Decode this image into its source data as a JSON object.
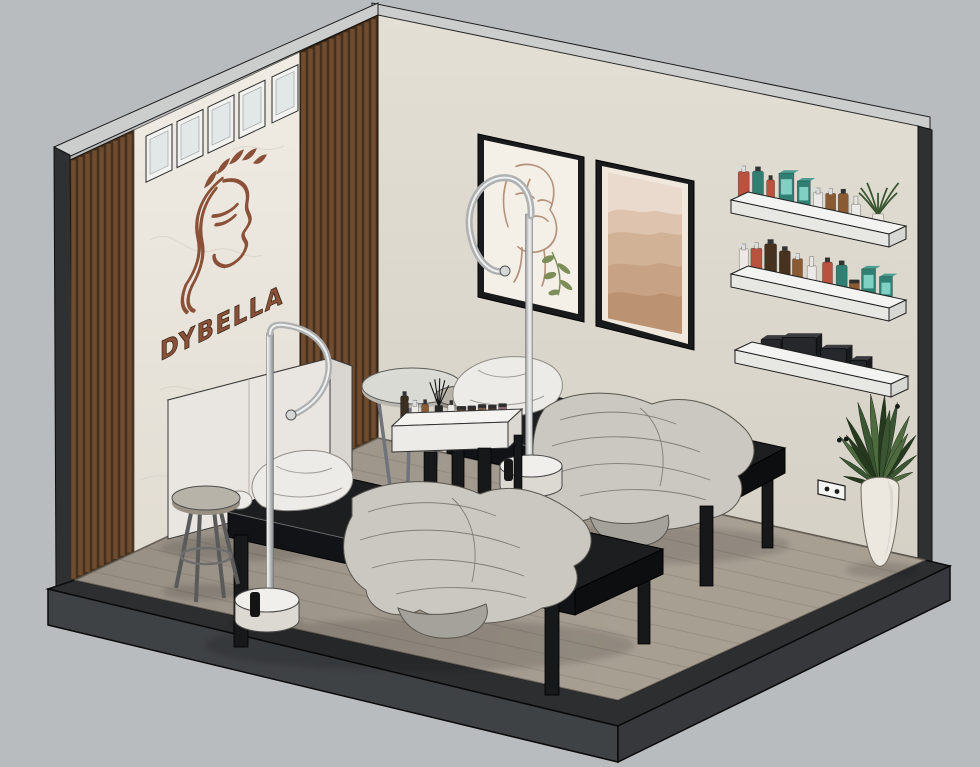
{
  "logo": {
    "text": "DYBELLA"
  },
  "palette": {
    "bg": "#b9bcbe",
    "capGray": "#cbcecd",
    "edgeDark": "#2e3032",
    "plinth": "#3f4245",
    "plinthRim": "#2c2e30",
    "floor": "#a89f93",
    "floorLine": "#8a8176",
    "marbleHi": "#f0ece4",
    "marbleLo": "#e2ddd3",
    "marbleVein": "#c9c3b8",
    "woodBase": "#44301d",
    "woodSlat": "#6f4b2f",
    "wallRightHi": "#e3dfd5",
    "wallRightLo": "#d6d1c6",
    "frameBlack": "#191a1b",
    "matWhite": "#f4efe7",
    "artLine": "#b39079",
    "artLeaf": "#7c8d57",
    "duneBg": "#eadace",
    "dune1": "#dec4ae",
    "dune2": "#d2b296",
    "dune3": "#c7a284",
    "dune4": "#bc9372",
    "shelfTop": "#f3f3f1",
    "shelfFront": "#e7e7e4",
    "shelfSide": "#d7d7d3",
    "towel": "#26272a",
    "towelHi": "#3a3b3f",
    "potWhite": "#ece8df",
    "potShade": "#d6d1c5",
    "leafDark": "#26391e",
    "leaf": "#3a5531",
    "leafHi": "#4e6b3f",
    "outletWhite": "#f4f4f2",
    "cabinetFront": "#e9e5e1",
    "cabinetTop": "#f5f3f0",
    "cabinetSide": "#d9d5d0",
    "stoolSeat": "#b7b3a9",
    "stoolSeatSide": "#978f82",
    "metal": "#70747a",
    "tableTop": "#dcdcd6",
    "bedBlack": "#1d1e20",
    "bedSide": "#121316",
    "bedSeam": "#d8d8d8",
    "legBlack": "#17181a",
    "pillow": "#edebe7",
    "pillowLine": "#8f8c86",
    "blanket": "#cbc8c2",
    "blanketShade": "#a5a29c",
    "blanketLine": "#6e6b65",
    "chrome": "#aeb0b1",
    "chromeHi": "#eff1f1",
    "lampBase": "#f1efec",
    "lampBaseSide": "#dcd9d3",
    "brand": "#8a5138",
    "brandDark": "#352114",
    "glass": "#e2e7e8",
    "windowFrame": "#f2f2f0",
    "trolleyTop": "#f5f3f0",
    "trolleyFront": "#edebe7",
    "trolleySide": "#dbd8d2",
    "productRed": "#b9523f",
    "productTeal": "#2f7f73",
    "productAmber": "#8a5a33",
    "productBrown": "#47311f",
    "productWhite": "#eceae6"
  },
  "windows": {
    "count": 5,
    "xs": [
      146,
      177,
      208,
      239,
      272
    ],
    "width": 26
  },
  "shelves": [
    {
      "items": [
        {
          "t": 0.03,
          "type": "pump",
          "color": "productRed",
          "h": 34,
          "w": 11
        },
        {
          "t": 0.12,
          "type": "bottle",
          "color": "productTeal",
          "h": 30,
          "w": 11
        },
        {
          "t": 0.2,
          "type": "bottle",
          "color": "productRed",
          "h": 24,
          "w": 8
        },
        {
          "t": 0.3,
          "type": "box",
          "color": "productTeal",
          "h": 34,
          "w": 15
        },
        {
          "t": 0.41,
          "type": "box",
          "color": "productTeal",
          "h": 30,
          "w": 13
        },
        {
          "t": 0.5,
          "type": "pump",
          "color": "productWhite",
          "h": 28,
          "w": 9
        },
        {
          "t": 0.58,
          "type": "pump",
          "color": "productAmber",
          "h": 30,
          "w": 10
        },
        {
          "t": 0.66,
          "type": "bottle",
          "color": "productAmber",
          "h": 26,
          "w": 10
        },
        {
          "t": 0.74,
          "type": "spray",
          "color": "productWhite",
          "h": 26,
          "w": 9
        },
        {
          "t": 0.88,
          "type": "shelfplant",
          "h": 40,
          "w": 26
        }
      ]
    },
    {
      "items": [
        {
          "t": 0.03,
          "type": "pump",
          "color": "productWhite",
          "h": 30,
          "w": 9
        },
        {
          "t": 0.11,
          "type": "pump",
          "color": "productRed",
          "h": 34,
          "w": 11
        },
        {
          "t": 0.2,
          "type": "bottle",
          "color": "productBrown",
          "h": 34,
          "w": 12
        },
        {
          "t": 0.29,
          "type": "bottle",
          "color": "productBrown",
          "h": 30,
          "w": 11
        },
        {
          "t": 0.37,
          "type": "pump",
          "color": "productAmber",
          "h": 32,
          "w": 10
        },
        {
          "t": 0.46,
          "type": "spray",
          "color": "productWhite",
          "h": 30,
          "w": 9
        },
        {
          "t": 0.56,
          "type": "bottle",
          "color": "productRed",
          "h": 28,
          "w": 10
        },
        {
          "t": 0.65,
          "type": "bottle",
          "color": "productTeal",
          "h": 28,
          "w": 11
        },
        {
          "t": 0.73,
          "type": "jar",
          "color": "productAmber",
          "h": 16,
          "w": 10
        },
        {
          "t": 0.82,
          "type": "box",
          "color": "productTeal",
          "h": 30,
          "w": 14
        },
        {
          "t": 0.93,
          "type": "box",
          "color": "productTeal",
          "h": 26,
          "w": 13
        }
      ]
    },
    {
      "towels": [
        {
          "t": 0.18,
          "w": 20,
          "h": 14
        },
        {
          "t": 0.36,
          "w": 34,
          "h": 22
        },
        {
          "t": 0.58,
          "w": 26,
          "h": 18
        },
        {
          "t": 0.74,
          "w": 16,
          "h": 12
        }
      ]
    }
  ],
  "trolley": {
    "items": [
      {
        "t": 0.04,
        "type": "bottle",
        "color": "#3a2d22",
        "h": 24,
        "w": 8
      },
      {
        "t": 0.13,
        "type": "pump",
        "color": "productWhite",
        "h": 21,
        "w": 7
      },
      {
        "t": 0.22,
        "type": "bottle",
        "color": "productAmber",
        "h": 15,
        "w": 7
      },
      {
        "t": 0.34,
        "type": "reed",
        "h": 36,
        "w": 8
      },
      {
        "t": 0.45,
        "type": "bottle",
        "color": "productWhite",
        "h": 13,
        "w": 7
      },
      {
        "t": 0.54,
        "type": "jar",
        "color": "#6b4a2e",
        "h": 11,
        "w": 9
      },
      {
        "t": 0.63,
        "type": "jar",
        "color": "#3f3226",
        "h": 11,
        "w": 8
      },
      {
        "t": 0.72,
        "type": "jar",
        "color": "#7a5a43",
        "h": 12,
        "w": 8
      },
      {
        "t": 0.81,
        "type": "jar",
        "color": "#4a3a30",
        "h": 11,
        "w": 8
      },
      {
        "t": 0.9,
        "type": "jar",
        "color": "#8a6a72",
        "h": 12,
        "w": 8
      }
    ]
  },
  "plant": {
    "leafAngles": [
      -78,
      -62,
      -48,
      -34,
      -20,
      -8,
      4,
      16,
      30,
      44,
      58,
      72,
      -42,
      10,
      36
    ],
    "leafLens": [
      52,
      64,
      76,
      84,
      90,
      94,
      92,
      88,
      82,
      72,
      60,
      48,
      70,
      78,
      66
    ]
  }
}
